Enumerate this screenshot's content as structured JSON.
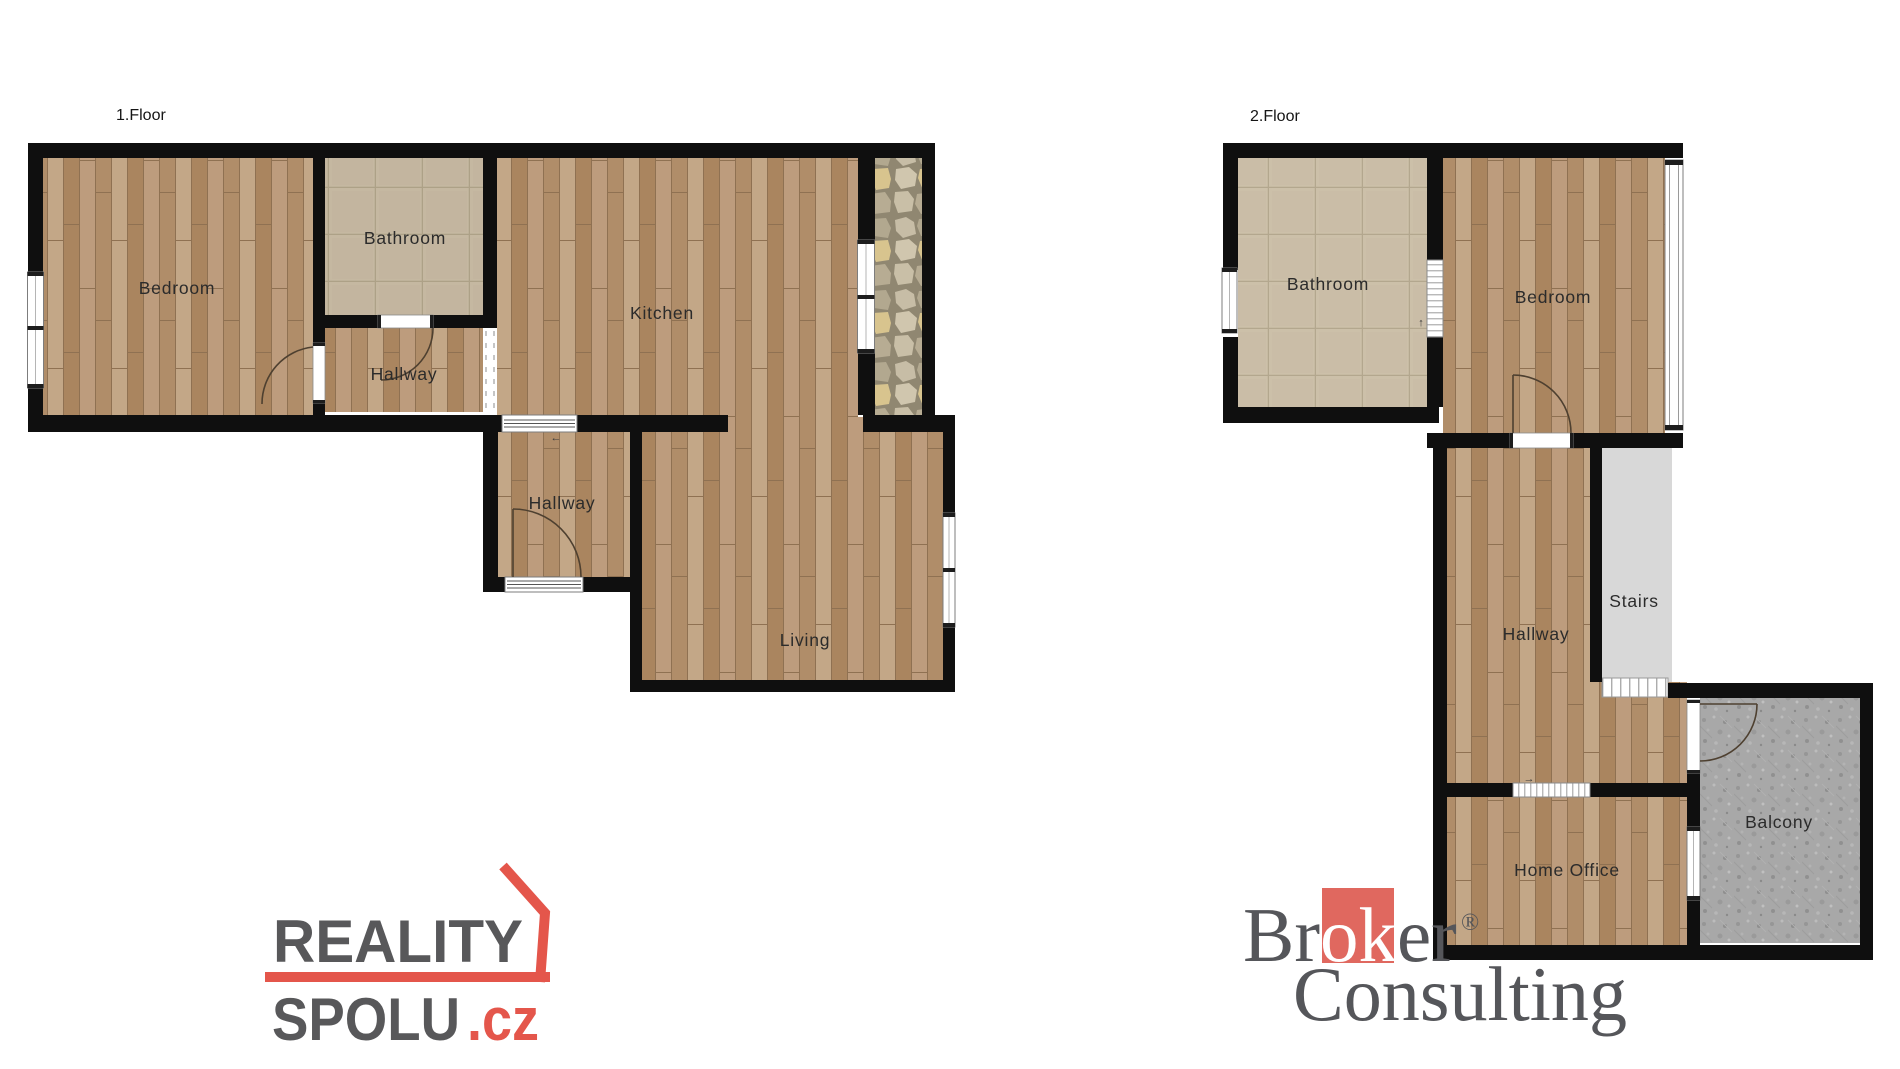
{
  "floor1": {
    "title": "1.Floor",
    "rooms": {
      "bedroom": "Bedroom",
      "bathroom": "Bathroom",
      "hallway_upper": "Hallway",
      "kitchen": "Kitchen",
      "hallway_lower": "Hallway",
      "living": "Living"
    }
  },
  "floor2": {
    "title": "2.Floor",
    "rooms": {
      "bathroom": "Bathroom",
      "bedroom": "Bedroom",
      "hallway": "Hallway",
      "stairs": "Stairs",
      "balcony": "Balcony",
      "home_office": "Home Office"
    }
  },
  "annotations": {
    "door_arrow_left": "←",
    "window_arrow_up": "↑",
    "window_arrow_right": "→"
  },
  "logos": {
    "reality_spolu": {
      "word1": "REALITY",
      "word2": "SPOLU",
      "tld": ".cz",
      "text_color": "#58585a",
      "accent_color": "#e4564b"
    },
    "broker_consulting": {
      "br": "Br",
      "ok": "ok",
      "er": "er",
      "registered": "®",
      "word2": "Consulting",
      "text_color": "#55565a",
      "accent_color": "#e0685f"
    }
  },
  "colors": {
    "wall": "#0f0f0f",
    "background": "#ffffff",
    "wood_floor": "#b2906e",
    "bathroom_tile": "#ccc0a9",
    "stone_strip": "#b9b09a",
    "balcony_concrete": "#a8a8a8",
    "stairs_fill": "#d8d8d8",
    "label_text": "#2b2b2b"
  }
}
